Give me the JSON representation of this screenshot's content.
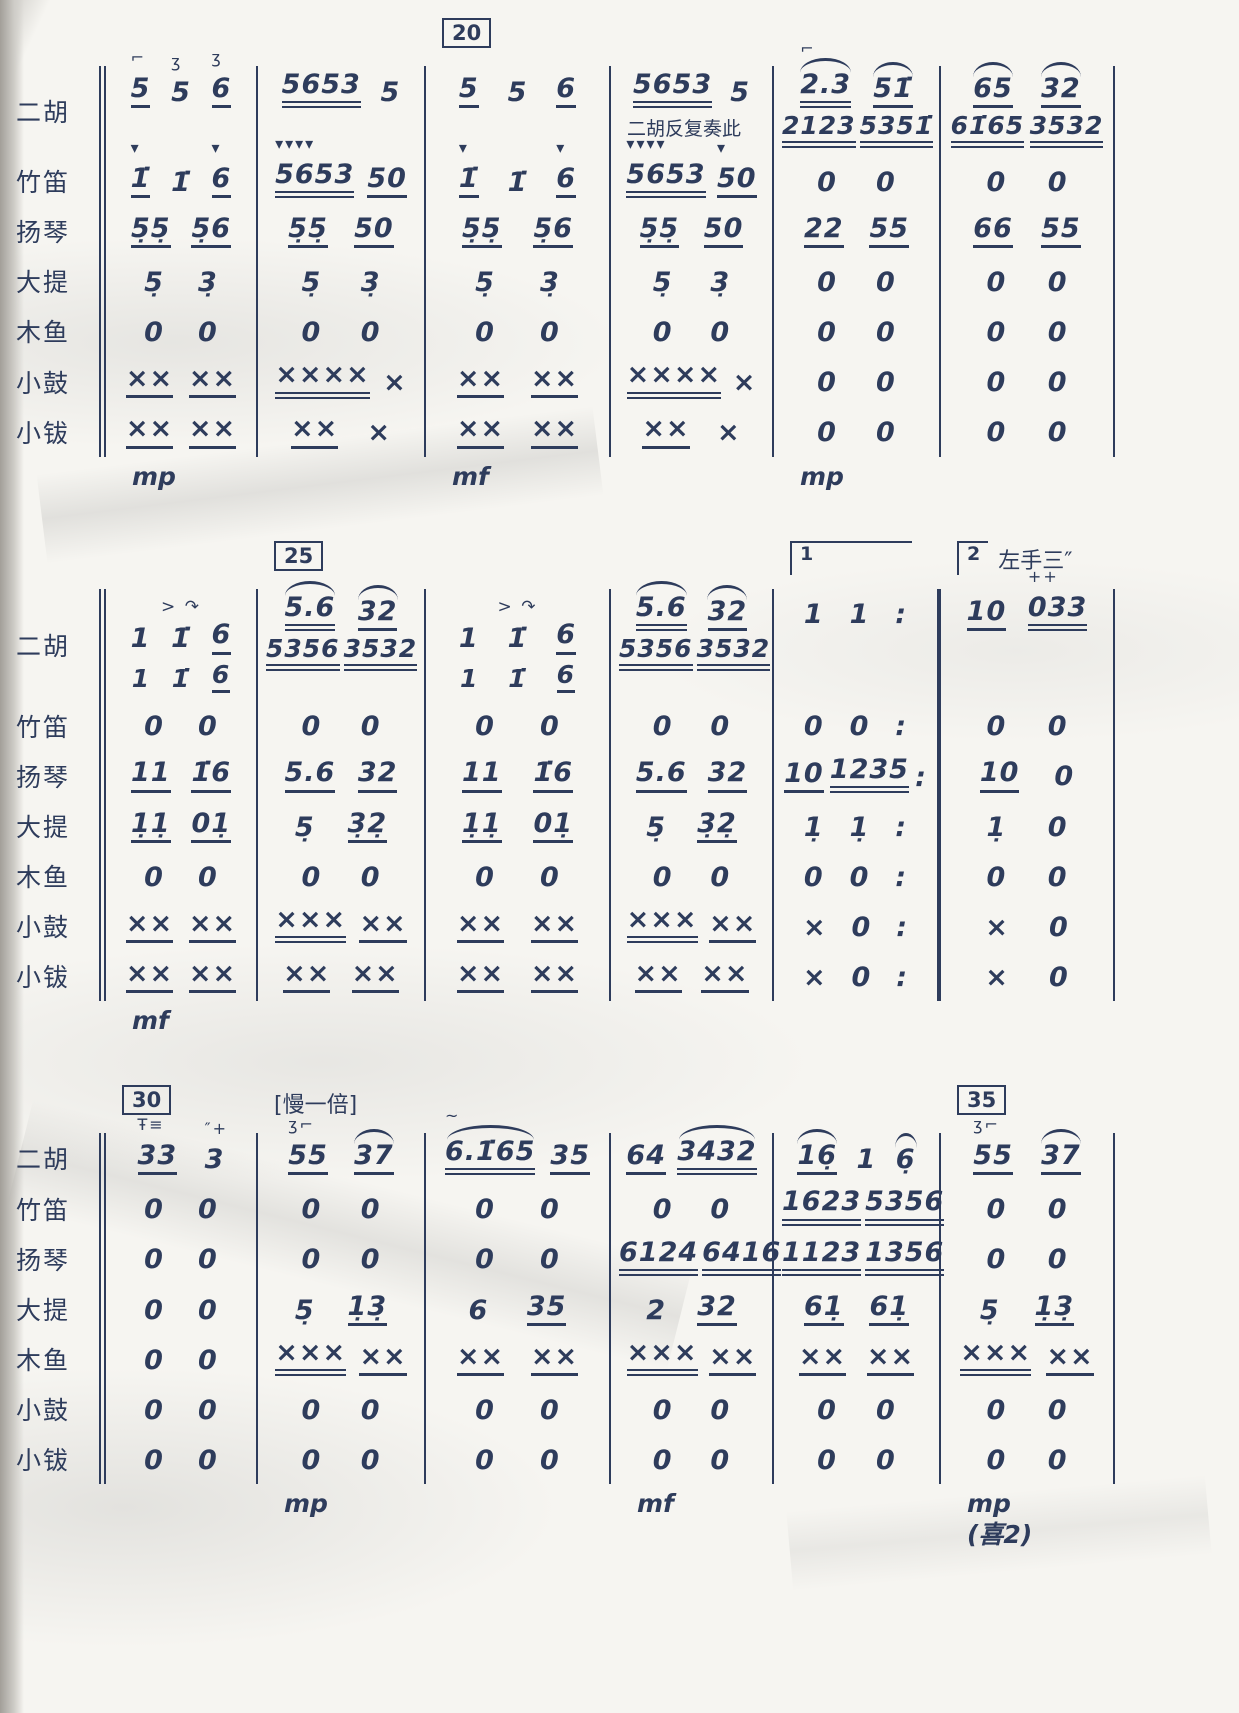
{
  "page": {
    "paper_color": "#f6f5f1",
    "ink_color": "#2e3c5c",
    "description_labels": {
      "dynamic_mp": "mp",
      "dynamic_mf": "mf",
      "footnote": "(喜2)"
    }
  },
  "score": {
    "instruments": [
      "二胡",
      "竹笛",
      "扬琴",
      "大提",
      "木鱼",
      "小鼓",
      "小钹"
    ],
    "rehearsal_numbers": [
      "20",
      "25",
      "30",
      "35"
    ],
    "tempo_annotation": "[慢一倍]",
    "repeat_annotation": "二胡反复奏此",
    "left_hand_annotation": "左手三″",
    "systems": [
      {
        "marks": [
          null,
          null,
          {
            "box": "20"
          },
          null,
          null,
          null
        ],
        "rows": [
          {
            "instrument": "二胡",
            "cells": [
              "5_@⌐ 5@ʒ 6_@ʒ",
              "5653__ 5",
              "5_ 5 6_",
              {
                "text": "5653__ 5",
                "note_below": "二胡反复奏此"
              },
              {
                "text": "^2.3__@⌐ ^51̇_",
                "below": "2123__ 5351̇__"
              },
              {
                "text": "^65_ ^32_",
                "below": "61̇65__ 3532__"
              }
            ]
          },
          {
            "instrument": "竹笛",
            "cells": [
              "1̇_@▾ 1̇ 6_@▾",
              "5653__@▾▾▾▾ 50_",
              "1̇_@▾ 1̇ 6_@▾",
              "5653__@▾▾▾▾ 50_@▾",
              "0 0",
              "0 0"
            ]
          },
          {
            "instrument": "扬琴",
            "cells": [
              "5̣5̣_ 5̣6_",
              "5̣5̣_ 50_",
              "5̣5̣_ 5̣6_",
              "5̣5̣_ 50_",
              "22_ 55_",
              "66_ 55_"
            ]
          },
          {
            "instrument": "大提",
            "cells": [
              "5̣ 3̣",
              "5̣ 3̣",
              "5̣ 3̣",
              "5̣ 3̣",
              "0 0",
              "0 0"
            ]
          },
          {
            "instrument": "木鱼",
            "cells": [
              "0 0",
              "0 0",
              "0 0",
              "0 0",
              "0 0",
              "0 0"
            ]
          },
          {
            "instrument": "小鼓",
            "cells": [
              "××_ ××_",
              "××××__ ×",
              "××_ ××_",
              "××××__ ×",
              "0 0",
              "0 0"
            ]
          },
          {
            "instrument": "小钹",
            "cells": [
              "××_ ××_",
              "××_ ×",
              "××_ ××_",
              "××_ ×",
              "0 0",
              "0 0"
            ]
          }
        ],
        "dynamics": [
          "mp",
          null,
          "mf",
          null,
          "mp",
          null
        ]
      },
      {
        "marks": [
          null,
          {
            "box": "25"
          },
          null,
          null,
          {
            "ending": "1"
          },
          {
            "ending": "2",
            "text": "左手三″"
          }
        ],
        "double_bar_after_measure": 5,
        "rows": [
          {
            "instrument": "二胡",
            "cells": [
              {
                "above": "> ↷",
                "text": "1 1̇ 6_",
                "below": "1 1̇ 6_"
              },
              {
                "text": "^5.6__ ^32_",
                "below": "5356__ 3532__"
              },
              {
                "above": "> ↷",
                "text": "1 1̇ 6_",
                "below": "1 1̇ 6_"
              },
              {
                "text": "^5.6__ ^32_",
                "below": "5356__ 3532__"
              },
              "1 1 :",
              "10_ 033__@++"
            ]
          },
          {
            "instrument": "竹笛",
            "cells": [
              "0 0",
              "0 0",
              "0 0",
              "0 0",
              "0 0 :",
              "0 0"
            ]
          },
          {
            "instrument": "扬琴",
            "cells": [
              "11_ 1̇6_",
              "5.6_ 32_",
              "11_ 1̇6_",
              "5.6_ 32_",
              "10_ 1235__ :",
              "10_ 0"
            ]
          },
          {
            "instrument": "大提",
            "cells": [
              "1̣1̣_ 01̣_",
              "5̣ 3̣2̣_",
              "1̣1̣_ 01̣_",
              "5̣ 3̣2̣_",
              "1̣ 1̣ :",
              "1̣ 0"
            ]
          },
          {
            "instrument": "木鱼",
            "cells": [
              "0 0",
              "0 0",
              "0 0",
              "0 0",
              "0 0 :",
              "0 0"
            ]
          },
          {
            "instrument": "小鼓",
            "cells": [
              "××_ ××_",
              "×××__ ××_",
              "××_ ××_",
              "×××__ ××_",
              "× 0 :",
              "× 0"
            ]
          },
          {
            "instrument": "小钹",
            "cells": [
              "××_ ××_",
              "××_ ××_",
              "××_ ××_",
              "××_ ××_",
              "× 0 :",
              "× 0"
            ]
          }
        ],
        "dynamics": [
          "mf",
          null,
          null,
          null,
          null,
          null
        ]
      },
      {
        "marks": [
          {
            "box": "30"
          },
          {
            "text": "[慢一倍]"
          },
          null,
          null,
          null,
          {
            "box": "35"
          }
        ],
        "rows": [
          {
            "instrument": "二胡",
            "cells": [
              "33_@Ŧ≡ 3@″+",
              "55_@ʒ⌐ ^37_",
              "^6.1̇65__@~ 35_",
              "64_ ^3432__",
              "^16̣_ 1 ^6̣",
              "55_@ʒ⌐ ^37_"
            ]
          },
          {
            "instrument": "竹笛",
            "cells": [
              "0 0",
              "0 0",
              "0 0",
              "0 0",
              "1623__ 5356__",
              "0 0"
            ]
          },
          {
            "instrument": "扬琴",
            "cells": [
              "0 0",
              "0 0",
              "0 0",
              "6124__ 6416__",
              "1123__ 1356__",
              "0 0"
            ]
          },
          {
            "instrument": "大提",
            "cells": [
              "0 0",
              "5̣ 1̣3̣_",
              "6 35_",
              "2 32_",
              "61̣_ 61̣_",
              "5̣ 1̣3̣_"
            ]
          },
          {
            "instrument": "木鱼",
            "cells": [
              "0 0",
              "×××__ ××_",
              "××_ ××_",
              "×××__ ××_",
              "××_ ××_",
              "×××__ ××_"
            ]
          },
          {
            "instrument": "小鼓",
            "cells": [
              "0 0",
              "0 0",
              "0 0",
              "0 0",
              "0 0",
              "0 0"
            ]
          },
          {
            "instrument": "小钹",
            "cells": [
              "0 0",
              "0 0",
              "0 0",
              "0 0",
              "0 0",
              "0 0"
            ]
          }
        ],
        "dynamics": [
          null,
          "mp",
          null,
          "mf",
          null,
          "mp\n(喜2)"
        ]
      }
    ]
  }
}
